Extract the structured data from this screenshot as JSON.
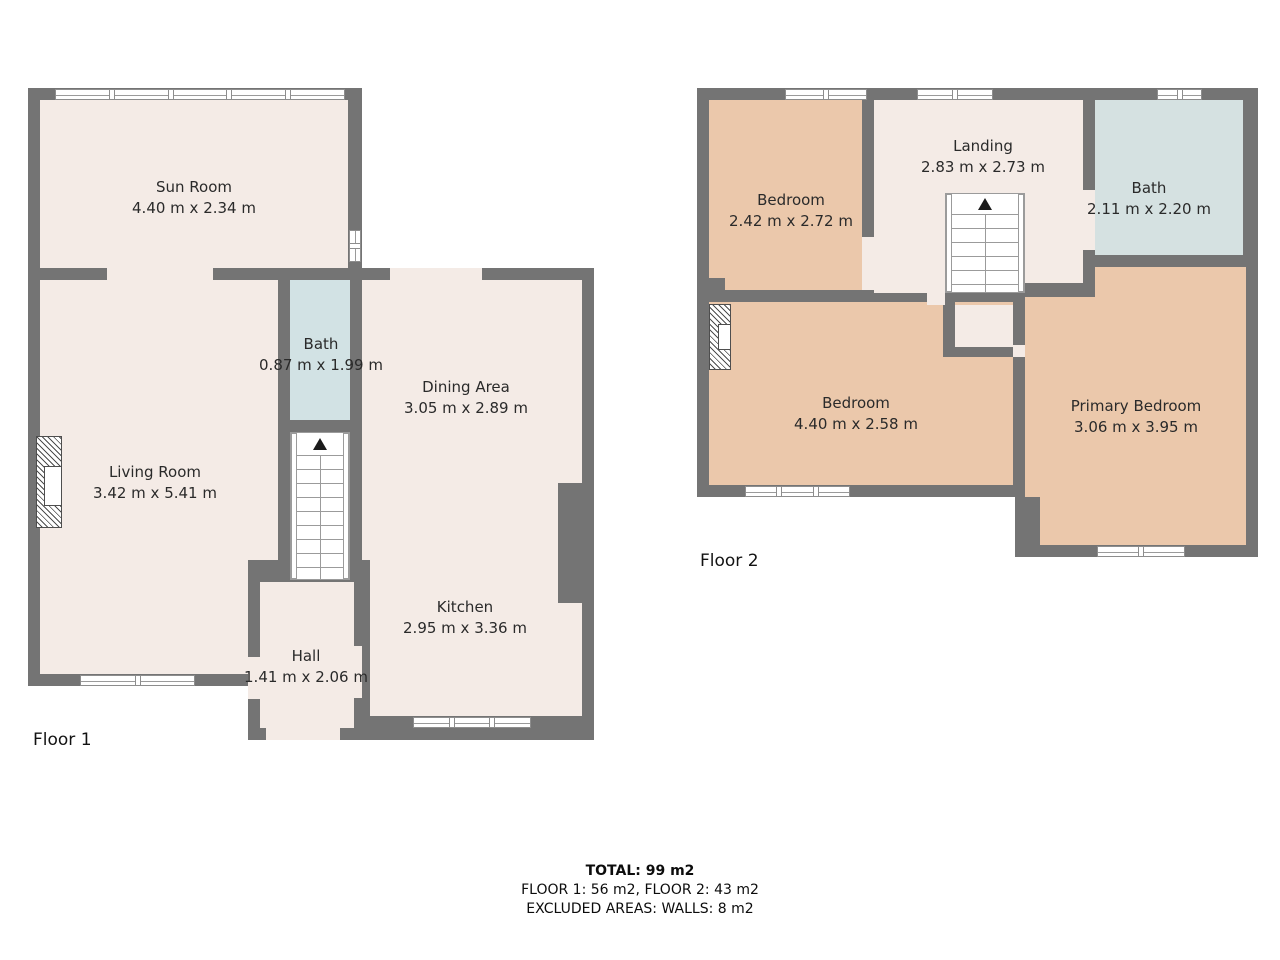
{
  "floor1": {
    "label": "Floor 1",
    "rooms": [
      {
        "name": "Sun Room",
        "dims": "4.40 m x 2.34 m"
      },
      {
        "name": "Living Room",
        "dims": "3.42 m x 5.41 m"
      },
      {
        "name": "Bath",
        "dims": "0.87 m x 1.99 m"
      },
      {
        "name": "Dining Area",
        "dims": "3.05 m x 2.89 m"
      },
      {
        "name": "Kitchen",
        "dims": "2.95 m x 3.36 m"
      },
      {
        "name": "Hall",
        "dims": "1.41 m x 2.06 m"
      }
    ]
  },
  "floor2": {
    "label": "Floor 2",
    "rooms": [
      {
        "name": "Bedroom",
        "dims": "2.42 m x 2.72 m"
      },
      {
        "name": "Landing",
        "dims": "2.83 m x 2.73 m"
      },
      {
        "name": "Bath",
        "dims": "2.11 m x 2.20 m"
      },
      {
        "name": "Bedroom",
        "dims": "4.40 m x 2.58 m"
      },
      {
        "name": "Primary Bedroom",
        "dims": "3.06 m x 3.95 m"
      }
    ]
  },
  "footer": {
    "total": "TOTAL: 99 m2",
    "floors": "FLOOR 1: 56 m2, FLOOR 2: 43 m2",
    "excluded": "EXCLUDED AREAS: WALLS: 8 m2"
  },
  "colors": {
    "wall": "#747474",
    "room_default": "#f4ebe6",
    "bedroom": "#ebc8ab",
    "bathroom": "#d3e2e3",
    "text": "#2a2a2a"
  }
}
